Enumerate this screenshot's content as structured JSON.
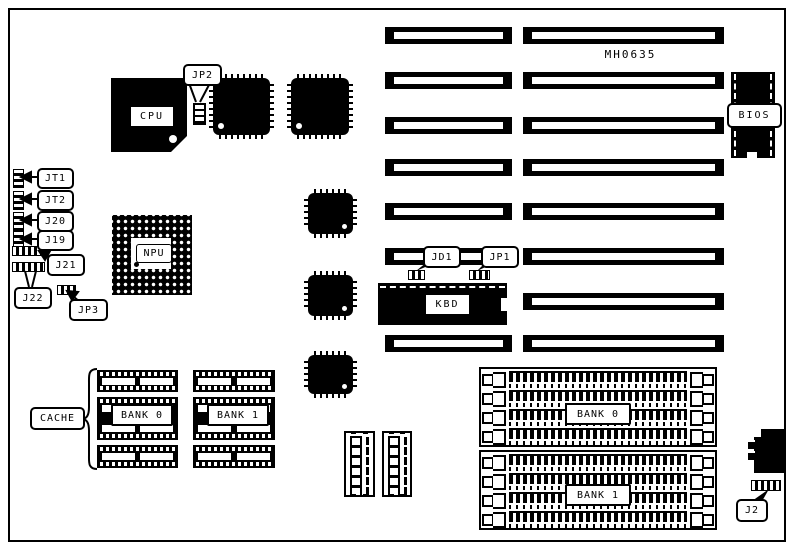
{
  "board": {
    "model_text": "MH0635"
  },
  "chips": {
    "cpu_label": "CPU",
    "npu_label": "NPU",
    "bios_label": "BIOS",
    "kbd_label": "KBD"
  },
  "cache": {
    "label": "CACHE",
    "bank0_label": "BANK 0",
    "bank1_label": "BANK 1"
  },
  "memory": {
    "bank0_label": "BANK 0",
    "bank1_label": "BANK 1"
  },
  "jumpers": {
    "jp2": "JP2",
    "jt1": "JT1",
    "jt2": "JT2",
    "j20": "J20",
    "j19": "J19",
    "j21": "J21",
    "j22": "J22",
    "jp3": "JP3",
    "jd1": "JD1",
    "jp1": "JP1",
    "j2": "J2"
  }
}
